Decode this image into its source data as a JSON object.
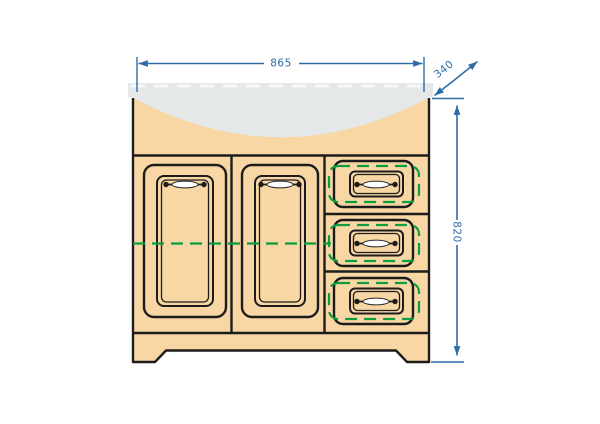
{
  "drawing": {
    "title": "Bathroom vanity cabinet technical drawing",
    "subject": "Vanity cabinet front elevation with inset sink top, two framed panel doors, three drawers and plinth base with cut-out legs",
    "annotations": {
      "width": "865",
      "depth": "340",
      "height": "820"
    },
    "legend": {
      "green_dashed_meaning": "hidden internal parts (shelf line and drawer boxes)",
      "gray_shape_meaning": "sink basin / countertop",
      "blue_lines_meaning": "dimension lines"
    },
    "components": {
      "doors": 2,
      "drawers": 3,
      "handles": 5
    },
    "colors": {
      "dimension_blue": "#2f6ba6",
      "outline_black": "#1c1c1c",
      "cabinet_fill": "#f8d7a5",
      "sink_gray": "#e5e8e9",
      "hidden_detail_green": "#089d3f",
      "background": "#ffffff"
    }
  }
}
